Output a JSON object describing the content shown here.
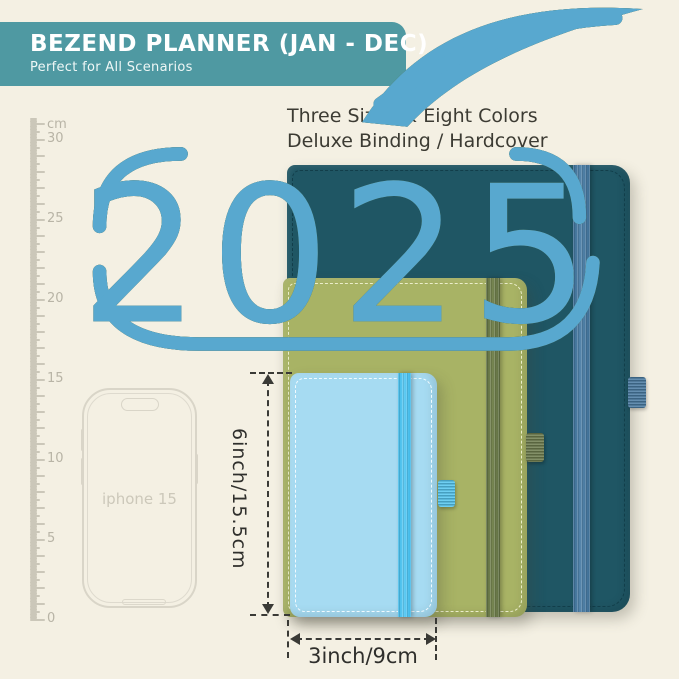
{
  "background_color": "#f4f0e3",
  "header": {
    "title": "BEZEND PLANNER (JAN - DEC)",
    "subtitle": "Perfect for All Scenarios",
    "banner_color": "#4f99a2"
  },
  "intro": {
    "line1": "Three Sizes & Eight Colors",
    "line2": "Deluxe Binding / Hardcover"
  },
  "ruler": {
    "unit_label": "cm",
    "tick_labels": [
      "30",
      "25",
      "20",
      "15",
      "10",
      "5",
      "0"
    ]
  },
  "phone": {
    "label": "iphone 15"
  },
  "planners": [
    {
      "name": "large-teal-planner",
      "year": "2025",
      "cover_color": "#1f5664",
      "stitch_color": "#123e4a",
      "band_color": "#5585ab",
      "band_dark_color": "#3d6e94",
      "loop_color": "#4a7ca3",
      "logo_color": "#113b47"
    },
    {
      "name": "medium-green-planner",
      "year": "2025",
      "cover_color": "#a8b365",
      "stitch_color": "#eaedca",
      "band_color": "#768551",
      "band_dark_color": "#5f6e42",
      "loop_color": "#6f7e4f",
      "logo_color": "#6f7e38"
    },
    {
      "name": "small-blue-planner",
      "year": "2025",
      "cover_color": "#a6dbf2",
      "stitch_color": "#f0fafe",
      "band_color": "#63cdf4",
      "band_dark_color": "#3fb8e7",
      "loop_color": "#57c7f0",
      "logo_color": "#58a8cf"
    }
  ],
  "dimensions": {
    "height_label": "6inch/15.5cm",
    "width_label": "3inch/9cm"
  }
}
